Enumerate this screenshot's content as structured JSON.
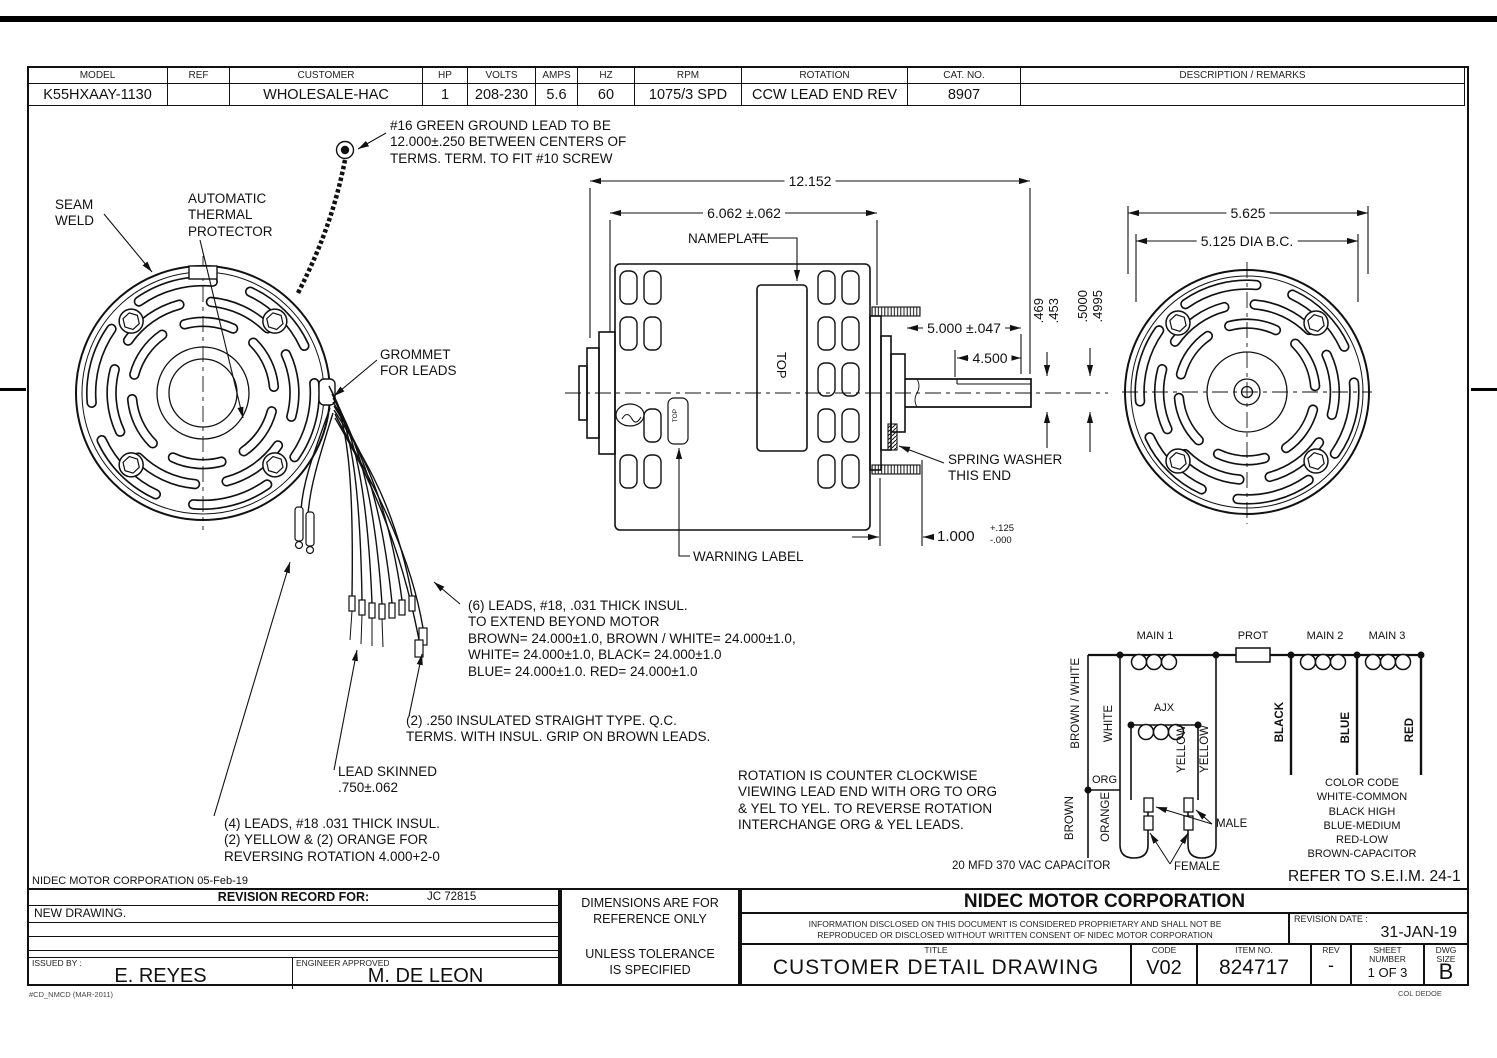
{
  "header_table": {
    "columns": [
      "MODEL",
      "REF",
      "CUSTOMER",
      "HP",
      "VOLTS",
      "AMPS",
      "HZ",
      "RPM",
      "ROTATION",
      "CAT. NO.",
      "DESCRIPTION / REMARKS"
    ],
    "values": [
      "K55HXAAY-1130",
      "",
      "WHOLESALE-HAC",
      "1",
      "208-230",
      "5.6",
      "60",
      "1075/3 SPD",
      "CCW LEAD END REV",
      "8907",
      ""
    ]
  },
  "notes": {
    "ground_lead": "#16 GREEN GROUND LEAD TO BE\n12.000±.250 BETWEEN CENTERS OF\nTERMS. TERM. TO FIT #10 SCREW",
    "seam_weld": "SEAM\nWELD",
    "thermal_protector": "AUTOMATIC\nTHERMAL\nPROTECTOR",
    "grommet": "GROMMET\nFOR LEADS",
    "nameplate": "NAMEPLATE",
    "spring_washer": "SPRING WASHER\nTHIS END",
    "warning_label": "WARNING LABEL",
    "leads6": "(6) LEADS, #18, .031 THICK INSUL.\nTO EXTEND BEYOND MOTOR\nBROWN= 24.000±1.0,  BROWN / WHITE= 24.000±1.0,\nWHITE= 24.000±1.0, BLACK= 24.000±1.0\nBLUE= 24.000±1.0. RED= 24.000±1.0",
    "qc_terms": "(2) .250 INSULATED STRAIGHT TYPE. Q.C.\nTERMS. WITH INSUL. GRIP ON BROWN LEADS.",
    "lead_skinned": "LEAD SKINNED\n.750±.062",
    "leads4": "(4) LEADS, #18 .031 THICK INSUL.\n(2) YELLOW & (2) ORANGE FOR\nREVERSING ROTATION 4.000+2-0",
    "rotation": "ROTATION IS COUNTER CLOCKWISE\nVIEWING LEAD END WITH ORG TO ORG\n& YEL TO YEL. TO REVERSE ROTATION\nINTERCHANGE ORG & YEL LEADS.",
    "capacitor": "20 MFD 370 VAC CAPACITOR",
    "color_code": "COLOR CODE\nWHITE-COMMON\nBLACK HIGH\nBLUE-MEDIUM\nRED-LOW\nBROWN-CAPACITOR",
    "refer": "REFER TO S.E.I.M. 24-1",
    "corp_date": "NIDEC MOTOR CORPORATION 05-Feb-19",
    "top_label": "TOP",
    "top_label_small": "TOP"
  },
  "dimensions": {
    "overall": "12.152",
    "body": "6.062 ±.062",
    "right_overall": "5.625",
    "bolt_circle": "5.125  DIA B.C.",
    "shaft_ext": "5.000 ±.047",
    "flat_len": "4.500",
    "flat_dim": ".469\n.453",
    "shaft_dia": ".5000\n.4995",
    "hub": "1.000",
    "hub_tol_plus": "+.125",
    "hub_tol_minus": "-.000"
  },
  "schematic": {
    "main1": "MAIN 1",
    "prot": "PROT",
    "main2": "MAIN 2",
    "main3": "MAIN 3",
    "aux": "AJX",
    "brown_white": "BROWN / WHITE",
    "white": "WHITE",
    "yellow1": "YELLOW",
    "yellow2": "YELLOW",
    "black": "BLACK",
    "blue": "BLUE",
    "red": "RED",
    "org": "ORG",
    "brown": "BROWN",
    "orange": "ORANGE",
    "male": "MALE",
    "female": "FEMALE"
  },
  "title_block": {
    "revision_record": "REVISION RECORD FOR:",
    "revision_ref": "JC 72815",
    "new_drawing": "NEW DRAWING.",
    "issued_by_label": "ISSUED BY :",
    "issued_by": "E. REYES",
    "approved_label": "ENGINEER APPROVED",
    "approved": "M. DE LEON",
    "dims_ref": "DIMENSIONS ARE FOR\nREFERENCE ONLY",
    "unless": "UNLESS TOLERANCE\nIS SPECIFIED",
    "company": "NIDEC MOTOR CORPORATION",
    "disclaimer": "INFORMATION DISCLOSED ON THIS DOCUMENT IS CONSIDERED PROPRIETARY AND SHALL NOT BE\nREPRODUCED OR DISCLOSED WITHOUT WRITTEN CONSENT OF NIDEC MOTOR CORPORATION",
    "revision_date_label": "REVISION DATE :",
    "revision_date": "31-JAN-19",
    "title_label": "TITLE",
    "title": "CUSTOMER  DETAIL  DRAWING",
    "code_label": "CODE",
    "code": "V02",
    "item_label": "ITEM NO.",
    "item": "824717",
    "rev_label": "REV",
    "rev": "-",
    "sheet_label": "SHEET\nNUMBER",
    "sheet": "1  OF  3",
    "size_label": "DWG\nSIZE",
    "size": "B",
    "form_code": "#CD_NMCD (MAR-2011)",
    "doc_code": "COL DEDOE"
  }
}
